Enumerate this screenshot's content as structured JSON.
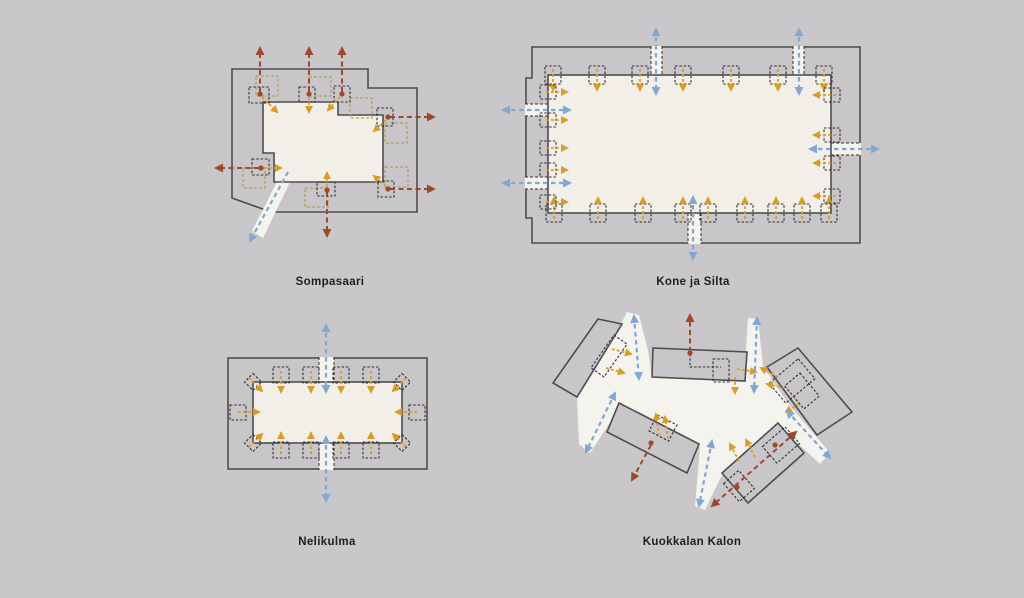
{
  "page": {
    "width": 1024,
    "height": 598,
    "background": "#c9c7c9"
  },
  "palette": {
    "page_bg": "#c9c7c9",
    "building_fill": "#c8c6c8",
    "building_outline": "#4d4d4f",
    "courtyard_fill": "#f2efe8",
    "passage_fill": "#f5f3ee",
    "arrow_blue": "#81a8d2",
    "arrow_red": "#9c4a2e",
    "arrow_orange": "#d89c28",
    "core_dash": "#2f2f31",
    "unit_dash": "#a8a262",
    "label_color": "#1f1f20"
  },
  "diagrams": [
    {
      "id": "sompasaari",
      "label": "Sompasaari"
    },
    {
      "id": "kone-ja-silta",
      "label": "Kone ja Silta"
    },
    {
      "id": "nelikulma",
      "label": "Nelikulma"
    },
    {
      "id": "kuokkalan-kalon",
      "label": "Kuokkalan Kalon"
    }
  ]
}
